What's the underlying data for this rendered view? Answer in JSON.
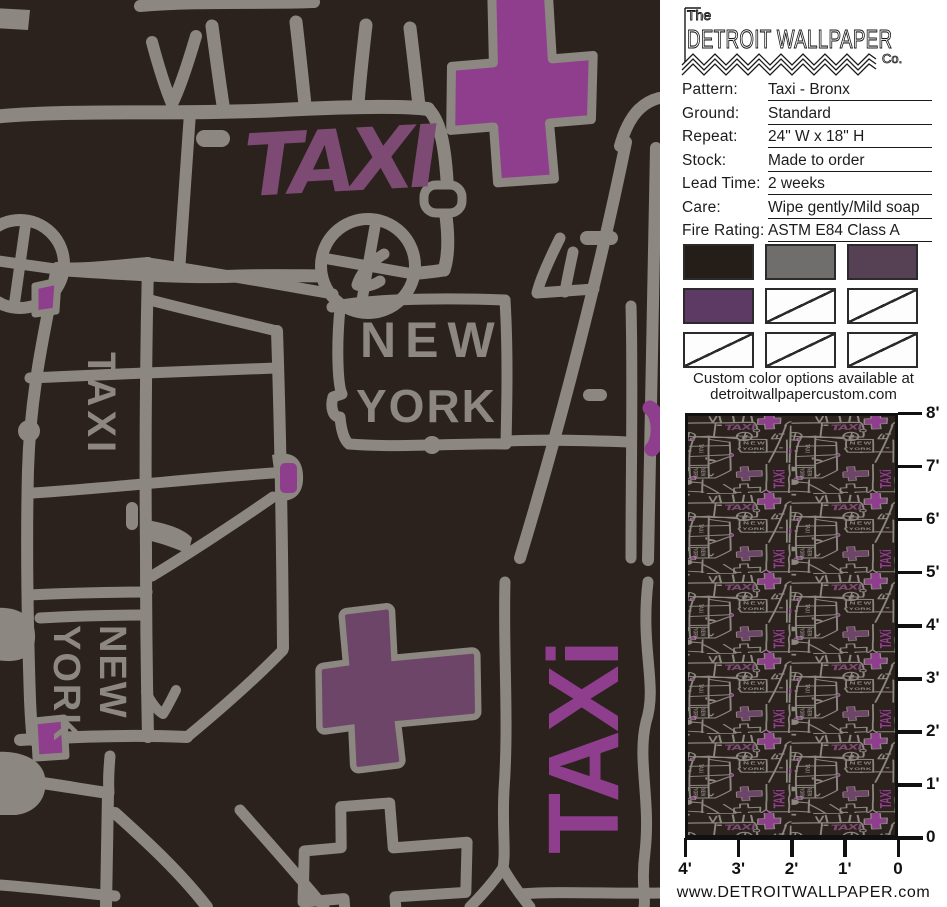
{
  "brand": {
    "prefix": "The",
    "name": "DETROIT WALLPAPER",
    "suffix": "Co."
  },
  "specs": [
    {
      "label": "Pattern:",
      "value": "Taxi - Bronx"
    },
    {
      "label": "Ground:",
      "value": "Standard"
    },
    {
      "label": "Repeat:",
      "value": "24\" W x 18\" H"
    },
    {
      "label": "Stock:",
      "value": "Made to order"
    },
    {
      "label": "Lead Time:",
      "value": "2 weeks"
    },
    {
      "label": "Care:",
      "value": "Wipe gently/Mild soap"
    },
    {
      "label": "Fire Rating:",
      "value": "ASTM E84 Class A"
    }
  ],
  "swatches": [
    {
      "color": "#241d18",
      "crossed": false
    },
    {
      "color": "#6f6e6c",
      "crossed": false
    },
    {
      "color": "#554054",
      "crossed": false
    },
    {
      "color": "#5d3a63",
      "crossed": false
    },
    {
      "color": "#fdfdfd",
      "crossed": true
    },
    {
      "color": "#fdfdfd",
      "crossed": true
    },
    {
      "color": "#fdfdfd",
      "crossed": true
    },
    {
      "color": "#fdfdfd",
      "crossed": true
    },
    {
      "color": "#fdfdfd",
      "crossed": true
    }
  ],
  "custom_note": {
    "line1": "Custom color options available at",
    "line2": "detroitwallpapercustom.com"
  },
  "scale_ruler": {
    "vertical_labels": [
      "8'",
      "7'",
      "6'",
      "5'",
      "4'",
      "3'",
      "2'",
      "1'",
      "0"
    ],
    "horizontal_labels": [
      "4'",
      "3'",
      "2'",
      "1'",
      "0"
    ]
  },
  "website": "www.DETROITWALLPAPER.com",
  "artwork": {
    "car_text": "TAXI",
    "sign_line1": "NEW",
    "sign_line2": "YORK",
    "van_text": "TAXI",
    "van_sign_line1": "NEW",
    "van_sign_line2": "YORK",
    "street_text": "TAXi",
    "colors": {
      "background": "#2b221d",
      "line_gray": "#8c8781",
      "bright_purple": "#8e3e8c",
      "muted_mauve": "#7c4a73",
      "cross_fill": "#6d4568"
    }
  }
}
